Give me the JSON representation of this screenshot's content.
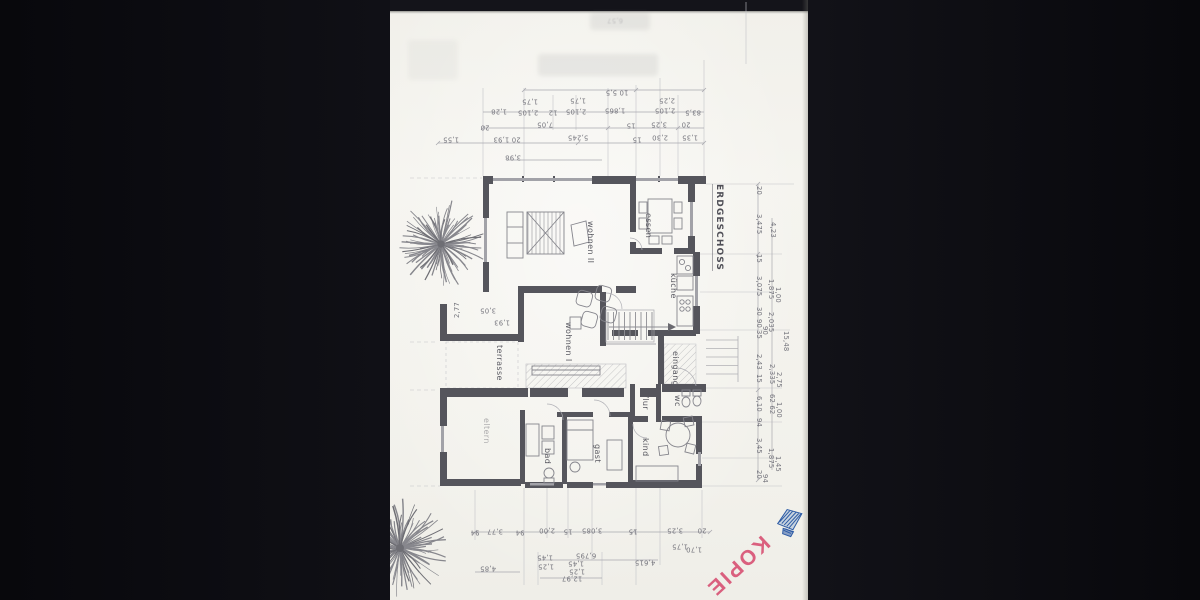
{
  "scan": {
    "stamp_text": "KOPIE",
    "stamp_color": "#d64b6e",
    "seal_color": "#2d5ba5",
    "paper_color": "#f4f3ee",
    "bed_color": "#0a0a0e"
  },
  "plan": {
    "title": {
      "t": "ERDGESCHOSS",
      "x": 330,
      "y": 184
    },
    "room_labels": [
      {
        "t": "wohnen II",
        "x": 200,
        "y": 221
      },
      {
        "t": "essen",
        "x": 258,
        "y": 213
      },
      {
        "t": "küche",
        "x": 283,
        "y": 273
      },
      {
        "t": "wohnen I",
        "x": 178,
        "y": 322
      },
      {
        "t": "terrasse",
        "x": 109,
        "y": 345
      },
      {
        "t": "eingang",
        "x": 285,
        "y": 351
      },
      {
        "t": "flur",
        "x": 255,
        "y": 395
      },
      {
        "t": "wc",
        "x": 287,
        "y": 395
      },
      {
        "t": "bad",
        "x": 157,
        "y": 448
      },
      {
        "t": "gast",
        "x": 207,
        "y": 444
      },
      {
        "t": "kind",
        "x": 255,
        "y": 438
      },
      {
        "t": "eltern",
        "x": 96,
        "y": 418,
        "faint": true
      }
    ],
    "dims_top": [
      {
        "t": "10 5,5",
        "x": 227,
        "y": 92
      },
      {
        "t": "1,28",
        "x": 109,
        "y": 111
      },
      {
        "t": "1,75",
        "x": 140,
        "y": 101
      },
      {
        "t": "2,105",
        "x": 138,
        "y": 112
      },
      {
        "t": "12",
        "x": 163,
        "y": 112
      },
      {
        "t": "1,75",
        "x": 188,
        "y": 100
      },
      {
        "t": "2,105",
        "x": 186,
        "y": 111
      },
      {
        "t": "1,865",
        "x": 225,
        "y": 110
      },
      {
        "t": "2,25",
        "x": 277,
        "y": 100
      },
      {
        "t": "2,105",
        "x": 275,
        "y": 110
      },
      {
        "t": "83,5",
        "x": 303,
        "y": 112
      },
      {
        "t": "20",
        "x": 95,
        "y": 127
      },
      {
        "t": "7,05",
        "x": 155,
        "y": 124
      },
      {
        "t": "15",
        "x": 241,
        "y": 125
      },
      {
        "t": "3,25",
        "x": 269,
        "y": 124
      },
      {
        "t": "20",
        "x": 296,
        "y": 124
      },
      {
        "t": "1,55",
        "x": 61,
        "y": 139
      },
      {
        "t": "20 1,93",
        "x": 117,
        "y": 139
      },
      {
        "t": "5,245",
        "x": 188,
        "y": 137
      },
      {
        "t": "15",
        "x": 247,
        "y": 139
      },
      {
        "t": "2,30",
        "x": 270,
        "y": 137
      },
      {
        "t": "1,35",
        "x": 300,
        "y": 137
      },
      {
        "t": "3,98",
        "x": 123,
        "y": 157
      }
    ],
    "dims_bottom": [
      {
        "t": "94",
        "x": 85,
        "y": 532
      },
      {
        "t": "3,77",
        "x": 105,
        "y": 531
      },
      {
        "t": "94",
        "x": 130,
        "y": 532
      },
      {
        "t": "2,00",
        "x": 157,
        "y": 530
      },
      {
        "t": "15",
        "x": 178,
        "y": 531
      },
      {
        "t": "3,085",
        "x": 202,
        "y": 530
      },
      {
        "t": "15",
        "x": 243,
        "y": 531
      },
      {
        "t": "3,25",
        "x": 285,
        "y": 530
      },
      {
        "t": "20",
        "x": 312,
        "y": 530
      },
      {
        "t": "1,75",
        "x": 290,
        "y": 546
      },
      {
        "t": "1,70",
        "x": 304,
        "y": 549
      },
      {
        "t": "1,45",
        "x": 155,
        "y": 557
      },
      {
        "t": "1,25",
        "x": 156,
        "y": 566
      },
      {
        "t": "6,795",
        "x": 196,
        "y": 555
      },
      {
        "t": "1,45",
        "x": 186,
        "y": 563
      },
      {
        "t": "1,25",
        "x": 187,
        "y": 571
      },
      {
        "t": "4,615",
        "x": 255,
        "y": 562
      },
      {
        "t": "4,85",
        "x": 98,
        "y": 568
      },
      {
        "t": "12,97",
        "x": 182,
        "y": 578
      }
    ],
    "dims_right": [
      {
        "t": "20",
        "x": 368,
        "y": 186
      },
      {
        "t": "3,475",
        "x": 368,
        "y": 214
      },
      {
        "t": "4,23",
        "x": 382,
        "y": 222
      },
      {
        "t": "15",
        "x": 368,
        "y": 254
      },
      {
        "t": "3,075",
        "x": 368,
        "y": 276
      },
      {
        "t": "1,875",
        "x": 380,
        "y": 279
      },
      {
        "t": "1,00",
        "x": 387,
        "y": 287
      },
      {
        "t": "30",
        "x": 368,
        "y": 307
      },
      {
        "t": "2,035",
        "x": 380,
        "y": 312
      },
      {
        "t": "90",
        "x": 368,
        "y": 319
      },
      {
        "t": "35",
        "x": 368,
        "y": 330
      },
      {
        "t": "90",
        "x": 374,
        "y": 326
      },
      {
        "t": "15,48",
        "x": 395,
        "y": 331
      },
      {
        "t": "2,43",
        "x": 368,
        "y": 354
      },
      {
        "t": "2,335",
        "x": 381,
        "y": 364
      },
      {
        "t": "2,75",
        "x": 388,
        "y": 372
      },
      {
        "t": "15",
        "x": 368,
        "y": 374
      },
      {
        "t": "6,10",
        "x": 368,
        "y": 396
      },
      {
        "t": "62 62",
        "x": 381,
        "y": 394
      },
      {
        "t": "1,00",
        "x": 388,
        "y": 402
      },
      {
        "t": "94",
        "x": 368,
        "y": 418
      },
      {
        "t": "3,45",
        "x": 368,
        "y": 438
      },
      {
        "t": "1,875",
        "x": 380,
        "y": 448
      },
      {
        "t": "1,45",
        "x": 387,
        "y": 456
      },
      {
        "t": "20",
        "x": 368,
        "y": 470
      },
      {
        "t": "94",
        "x": 374,
        "y": 474
      }
    ],
    "dims_misc": [
      {
        "t": "2,77",
        "x": 68,
        "y": 318,
        "rot": -90
      },
      {
        "t": "3,05",
        "x": 98,
        "y": 310,
        "rot": 180
      },
      {
        "t": "1,93",
        "x": 112,
        "y": 322,
        "rot": 180
      }
    ],
    "artifact_text": [
      {
        "t": "6,57",
        "x": 225,
        "y": 20,
        "rot": 180
      }
    ]
  }
}
